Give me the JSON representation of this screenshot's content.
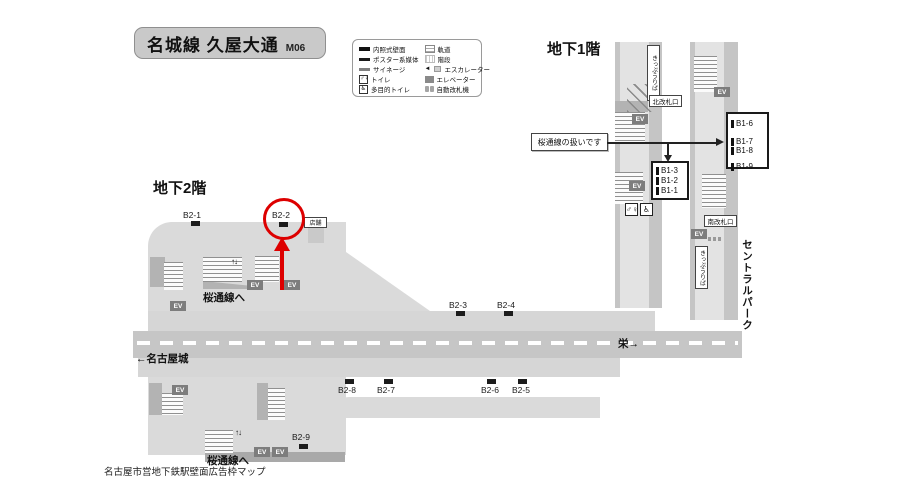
{
  "header": {
    "title": "名城線 久屋大通",
    "station_code": "M06"
  },
  "caption": "名古屋市営地下鉄駅壁面広告枠マップ",
  "floor_labels": {
    "b1": "地下1階",
    "b2": "地下2階"
  },
  "legend": {
    "left": [
      {
        "label": "内照式壁面"
      },
      {
        "label": "ポスター系媒体"
      },
      {
        "label": "サイネージ"
      },
      {
        "label": "トイレ"
      },
      {
        "label": "多目的トイレ"
      }
    ],
    "right": [
      {
        "label": "軌道"
      },
      {
        "label": "階段"
      },
      {
        "label": "エスカレーター"
      },
      {
        "label": "エレベーター"
      },
      {
        "label": "自動改札機"
      }
    ]
  },
  "b1": {
    "note": "桜通線の扱いです",
    "north_gate": "北改札口",
    "south_gate": "南改札口",
    "ticket_office_left": "きっぷうりば",
    "ticket_office_right": "きっぷうりば",
    "central_park": "セントラルパーク",
    "ad_box_left": [
      "B1-3",
      "B1-2",
      "B1-1"
    ],
    "ad_box_right": [
      "B1-6",
      "B1-7",
      "B1-8",
      "B1-9"
    ]
  },
  "b2": {
    "to_sakuradori_upper": "桜通線へ",
    "to_sakuradori_lower": "桜通線へ",
    "store": "店舗",
    "nagoya_castle": "←名古屋城",
    "sakae": "栄→",
    "positions": {
      "b2_1": "B2-1",
      "b2_2": "B2-2",
      "b2_3": "B2-3",
      "b2_4": "B2-4",
      "b2_5": "B2-5",
      "b2_6": "B2-6",
      "b2_7": "B2-7",
      "b2_8": "B2-8",
      "b2_9": "B2-9"
    },
    "highlighted": "B2-2"
  },
  "common": {
    "elevator": "EV",
    "escalator_arrows": "↑↓"
  },
  "colors": {
    "highlight_red": "#dd0000",
    "map_gray": "#dadada",
    "track_gray": "#c6c6c6"
  }
}
